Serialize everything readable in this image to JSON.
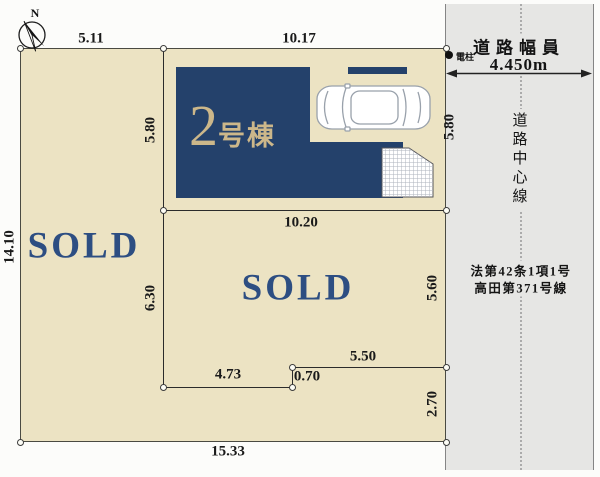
{
  "compass": {
    "north_label": "N"
  },
  "site": {
    "building": {
      "number": "2",
      "suffix": "号棟"
    },
    "lot_left": {
      "status": "SOLD"
    },
    "lot_lower": {
      "status": "SOLD"
    },
    "dims": {
      "top_left": "5.11",
      "top_right": "10.17",
      "left": "14.10",
      "building_side_left": "5.80",
      "building_side_right": "5.80",
      "building_bottom": "10.20",
      "lower_left": "6.30",
      "lower_right": "5.60",
      "bottom_step_a": "4.73",
      "bottom_step_b": "0.70",
      "bottom_step_c": "5.50",
      "right_bottom": "2.70",
      "bottom": "15.33"
    }
  },
  "road": {
    "width_caption": "道路幅員",
    "width_value": "4.450m",
    "center_line_label": "道路中心線",
    "law_line1": "法第42条1項1号",
    "law_line2": "高田第371号線",
    "utility_pole_label": "電柱"
  },
  "colors": {
    "lot_fill": "#ece3c3",
    "building_fill": "#24416b",
    "building_text": "#ccb78a",
    "sold_text": "#2d4e82",
    "road_fill": "#e6e6e4"
  }
}
